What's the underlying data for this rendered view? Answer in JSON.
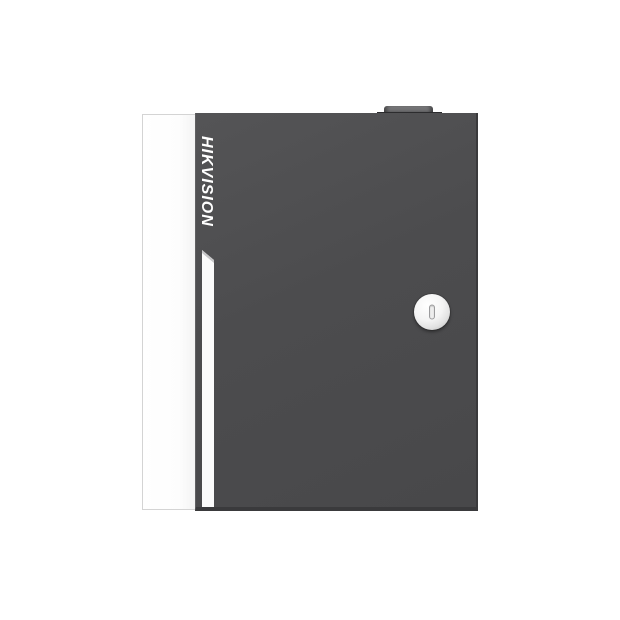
{
  "product": {
    "brand": "HIKVISION"
  },
  "icons": {
    "keyhole": "keyhole-icon"
  },
  "colors": {
    "page_background": "#ffffff",
    "door_face": "#4c4c4e",
    "door_edge_shadow": "#3a3a3c",
    "side_panel": "#fdfdfd",
    "side_panel_border": "#d4d4d4",
    "accent_stripe": "#fbfbfb",
    "brand_text": "#ffffff",
    "lock_face": "#f4f4f4",
    "lock_rim": "#a8a8a8",
    "keyhole_slot": "#9b9b9d",
    "hinge": "#646466",
    "hinge_base": "#2c2c2e"
  }
}
